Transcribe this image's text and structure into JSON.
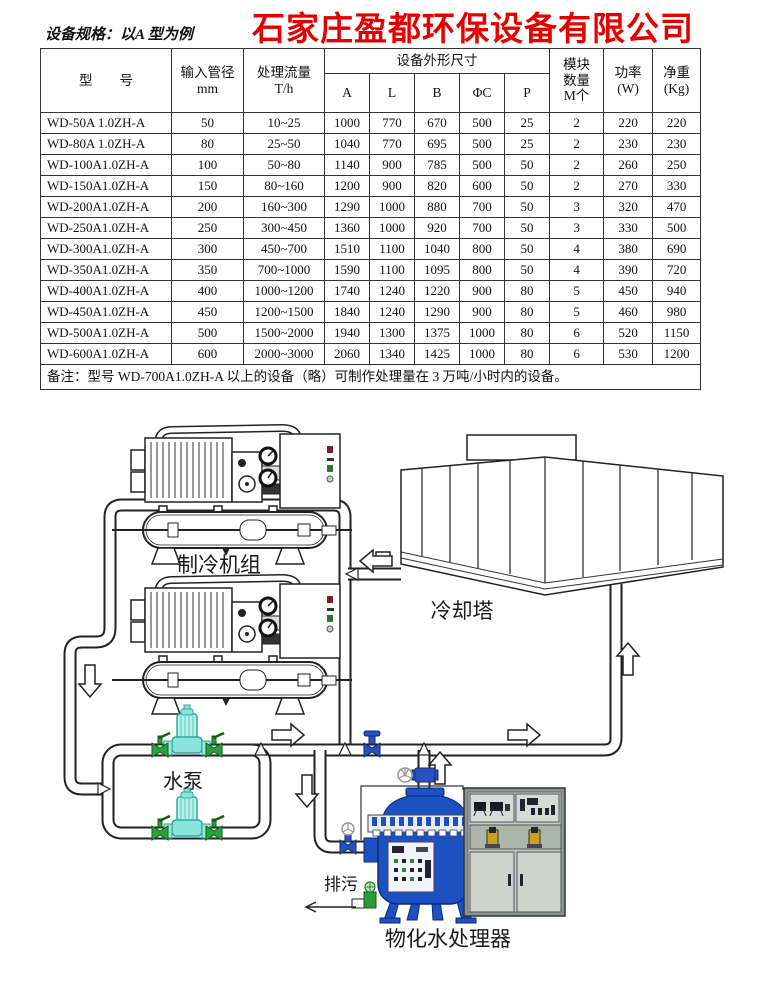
{
  "company": {
    "title": "石家庄盈都环保设备有限公司",
    "subtitle": "设备规格：以A 型为例"
  },
  "colors": {
    "title_red": "#e60000",
    "pipe_outline": "#222222",
    "pump_cyan": "#7fe3db",
    "valve_green": "#2aa23a",
    "valve_blue": "#2a50c0",
    "vessel_blue": "#1d50c0",
    "cabinet_gray": "#c2ccc2"
  },
  "table": {
    "header": {
      "model": "型　　号",
      "pipe_l1": "输入管径",
      "pipe_l2": "mm",
      "flow_l1": "处理流量",
      "flow_l2": "T/h",
      "dims": "设备外形尺寸",
      "dim_cols": [
        "A",
        "L",
        "B",
        "ΦC",
        "P"
      ],
      "module_l1": "模块",
      "module_l2": "数量",
      "module_l3": "M个",
      "power_l1": "功率",
      "power_l2": "(W)",
      "weight_l1": "净重",
      "weight_l2": "(Kg)"
    },
    "rows": [
      [
        "WD-50A 1.0ZH-A",
        "50",
        "10~25",
        "1000",
        "770",
        "670",
        "500",
        "25",
        "2",
        "220",
        "220"
      ],
      [
        "WD-80A 1.0ZH-A",
        "80",
        "25~50",
        "1040",
        "770",
        "695",
        "500",
        "25",
        "2",
        "230",
        "230"
      ],
      [
        "WD-100A1.0ZH-A",
        "100",
        "50~80",
        "1140",
        "900",
        "785",
        "500",
        "50",
        "2",
        "260",
        "250"
      ],
      [
        "WD-150A1.0ZH-A",
        "150",
        "80~160",
        "1200",
        "900",
        "820",
        "600",
        "50",
        "2",
        "270",
        "330"
      ],
      [
        "WD-200A1.0ZH-A",
        "200",
        "160~300",
        "1290",
        "1000",
        "880",
        "700",
        "50",
        "3",
        "320",
        "470"
      ],
      [
        "WD-250A1.0ZH-A",
        "250",
        "300~450",
        "1360",
        "1000",
        "920",
        "700",
        "50",
        "3",
        "330",
        "500"
      ],
      [
        "WD-300A1.0ZH-A",
        "300",
        "450~700",
        "1510",
        "1100",
        "1040",
        "800",
        "50",
        "4",
        "380",
        "690"
      ],
      [
        "WD-350A1.0ZH-A",
        "350",
        "700~1000",
        "1590",
        "1100",
        "1095",
        "800",
        "50",
        "4",
        "390",
        "720"
      ],
      [
        "WD-400A1.0ZH-A",
        "400",
        "1000~1200",
        "1740",
        "1240",
        "1220",
        "900",
        "80",
        "5",
        "450",
        "940"
      ],
      [
        "WD-450A1.0ZH-A",
        "450",
        "1200~1500",
        "1840",
        "1240",
        "1290",
        "900",
        "80",
        "5",
        "460",
        "980"
      ],
      [
        "WD-500A1.0ZH-A",
        "500",
        "1500~2000",
        "1940",
        "1300",
        "1375",
        "1000",
        "80",
        "6",
        "520",
        "1150"
      ],
      [
        "WD-600A1.0ZH-A",
        "600",
        "2000~3000",
        "2060",
        "1340",
        "1425",
        "1000",
        "80",
        "6",
        "530",
        "1200"
      ]
    ],
    "note": "备注：型号 WD-700A1.0ZH-A 以上的设备（略）可制作处理量在 3 万吨/小时内的设备。"
  },
  "diagram": {
    "labels": {
      "chiller": "制冷机组",
      "cooling_tower": "冷却塔",
      "pump": "水泵",
      "drain": "排污",
      "processor": "物化水处理器"
    }
  }
}
